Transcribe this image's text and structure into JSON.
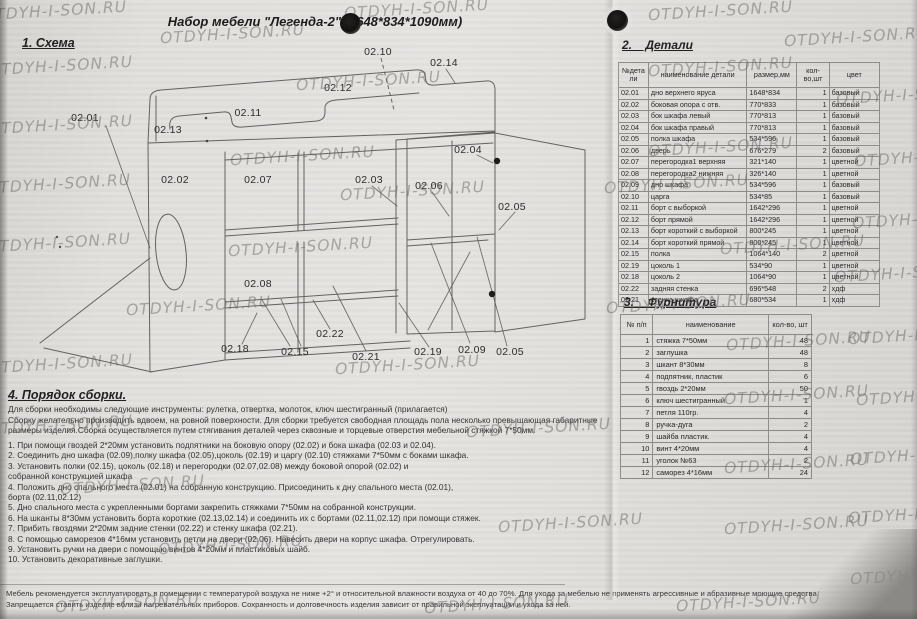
{
  "watermark": {
    "text": "OTDYH-I-SON.RU"
  },
  "title": "Набор мебели \"Легенда-2\" (1648*834*1090мм)",
  "schema": {
    "heading": "1. Схема"
  },
  "diagram": {
    "labels": [
      {
        "t": "02.01",
        "x": 85,
        "y": 118
      },
      {
        "t": "02.13",
        "x": 168,
        "y": 130
      },
      {
        "t": "02.11",
        "x": 248,
        "y": 113
      },
      {
        "t": "02.12",
        "x": 338,
        "y": 88
      },
      {
        "t": "02.10",
        "x": 378,
        "y": 52
      },
      {
        "t": "02.14",
        "x": 444,
        "y": 63
      },
      {
        "t": "02.04",
        "x": 468,
        "y": 150
      },
      {
        "t": "02.02",
        "x": 175,
        "y": 180
      },
      {
        "t": "02.07",
        "x": 258,
        "y": 180
      },
      {
        "t": "02.03",
        "x": 369,
        "y": 180
      },
      {
        "t": "02.06",
        "x": 429,
        "y": 186
      },
      {
        "t": "02.05",
        "x": 512,
        "y": 207
      },
      {
        "t": "02.08",
        "x": 258,
        "y": 284
      },
      {
        "t": "02.18",
        "x": 235,
        "y": 349
      },
      {
        "t": "02.15",
        "x": 295,
        "y": 352
      },
      {
        "t": "02.22",
        "x": 330,
        "y": 334
      },
      {
        "t": "02.21",
        "x": 366,
        "y": 357
      },
      {
        "t": "02.19",
        "x": 428,
        "y": 352
      },
      {
        "t": "02.09",
        "x": 472,
        "y": 350
      },
      {
        "t": "02.05",
        "x": 510,
        "y": 352
      }
    ]
  },
  "details": {
    "heading": "2.    Детали",
    "columns": [
      "№дета\nли",
      "наименование детали",
      "размер,мм",
      "кол-\nво,шт",
      "цвет"
    ],
    "rows": [
      [
        "02.01",
        "дно верхнего яруса",
        "1648*834",
        "1",
        "базовый"
      ],
      [
        "02.02",
        "боковая опора с отв.",
        "770*833",
        "1",
        "базовый"
      ],
      [
        "02.03",
        "бок шкафа левый",
        "770*813",
        "1",
        "базовый"
      ],
      [
        "02.04",
        "бок шкафа правый",
        "770*813",
        "1",
        "базовый"
      ],
      [
        "02.05",
        "полка шкафа",
        "534*596",
        "1",
        "базовый"
      ],
      [
        "02.06",
        "дверь",
        "676*279",
        "2",
        "базовый"
      ],
      [
        "02.07",
        "перегородка1 верхняя",
        "321*140",
        "1",
        "цветной"
      ],
      [
        "02.08",
        "перегородка2 нижняя",
        "326*140",
        "1",
        "цветной"
      ],
      [
        "02.09",
        "дно шкафа",
        "534*596",
        "1",
        "базовый"
      ],
      [
        "02.10",
        "царга",
        "534*85",
        "1",
        "базовый"
      ],
      [
        "02.11",
        "борт с выборкой",
        "1642*296",
        "1",
        "цветной"
      ],
      [
        "02.12",
        "борт прямой",
        "1642*296",
        "1",
        "цветной"
      ],
      [
        "02.13",
        "борт короткий с выборкой",
        "800*245",
        "1",
        "цветной"
      ],
      [
        "02.14",
        "борт короткий прямой",
        "800*245",
        "1",
        "цветной"
      ],
      [
        "02.15",
        "полка",
        "1064*140",
        "2",
        "цветной"
      ],
      [
        "02.19",
        "цоколь 1",
        "534*90",
        "1",
        "цветной"
      ],
      [
        "02.18",
        "цоколь 2",
        "1064*90",
        "1",
        "цветной"
      ],
      [
        "02.22",
        "задняя стенка",
        "696*548",
        "2",
        "хдф"
      ],
      [
        "02.21",
        "стенка шкафа",
        "680*534",
        "1",
        "хдф"
      ]
    ]
  },
  "hardware": {
    "heading": "3.    Фурнитура",
    "columns": [
      "№ п/п",
      "наименование",
      "кол-во, шт"
    ],
    "rows": [
      [
        "1",
        "стяжка 7*50мм",
        "48"
      ],
      [
        "2",
        "заглушка",
        "48"
      ],
      [
        "3",
        "шкант 8*30мм",
        "8"
      ],
      [
        "4",
        "подпятник, пластик",
        "6"
      ],
      [
        "5",
        "гвоздь 2*20мм",
        "50"
      ],
      [
        "6",
        "ключ шестигранный",
        "1"
      ],
      [
        "7",
        "петля 110гр.",
        "4"
      ],
      [
        "8",
        "ручка-дуга",
        "2"
      ],
      [
        "9",
        "шайба пластик.",
        "4"
      ],
      [
        "10",
        "винт 4*20мм",
        "4"
      ],
      [
        "11",
        "уголок №63",
        "2"
      ],
      [
        "12",
        "саморез 4*16мм",
        "24"
      ]
    ]
  },
  "assembly": {
    "heading": "4. Порядок сборки.",
    "intro_lines": [
      "Для сборки необходимы следующие инструменты: рулетка, отвертка, молоток, ключ шестигранный (прилагается)",
      "Сборку желательно производить вдвоем, на ровной поверхности. Для сборки требуется свободная площадь пола несколько превышающая габаритные",
      "размеры изделия.Сборка осуществляется путем стягивания деталей через сквозные и торцевые отверстия мебельной стяжкой 7*50мм."
    ],
    "steps": [
      "1. При помощи гвоздей 2*20мм установить подпятники на боковую опору (02.02) и бока шкафа (02.03 и 02.04).",
      "2. Соединить дно шкафа (02.09),полку шкафа (02.05),цоколь (02.19) и царгу (02.10)  стяжками 7*50мм с боками шкафа.",
      "3. Установить полки (02.15), цоколь (02.18) и перегородки (02.07,02.08) между боковой опорой (02.02) и\nсобранной конструкцией шкафа",
      "4. Положить дно спального места (02.01) на собранную конструкцию. Присоединить к дну спального места (02.01),\nборта (02.11,02.12)",
      "5. Дно спального места с укрепленными бортами закрепить стяжками 7*50мм на собранной конструкции.",
      "6. На шканты 8*30мм установить борта короткие (02.13,02.14) и соединить их с бортами (02.11,02.12) при помощи стяжек.",
      "7. Прибить гвоздями 2*20мм задние стенки (02.22) и стенку шкафа (02.21).",
      "8. С помощью саморезов 4*16мм установить петли на двери (02.06). Навесить двери на корпус шкафа. Отрегулировать.",
      "9. Установить ручки на двери с помощью винтов 4*20мм и пластиковых шайб.",
      "10. Установить декоративные заглушки."
    ]
  },
  "footer": {
    "lines": [
      "Мебель рекомендуется эксплуатировать в помещении с температурой воздуха не ниже +2° и относительной влажности воздуха от 40 до 70%.  Для ухода за мебелью не применять агрессивные и абразивные моющие средства",
      "Запрещается ставить изделие вблизи нагревательных приборов. Сохранность и долговечность изделия зависит от правильной эксплуатации и ухода за ней."
    ]
  },
  "colors": {
    "paper": "#e2e0dd",
    "ink": "#333333",
    "watermark": "#8a8a8a"
  }
}
